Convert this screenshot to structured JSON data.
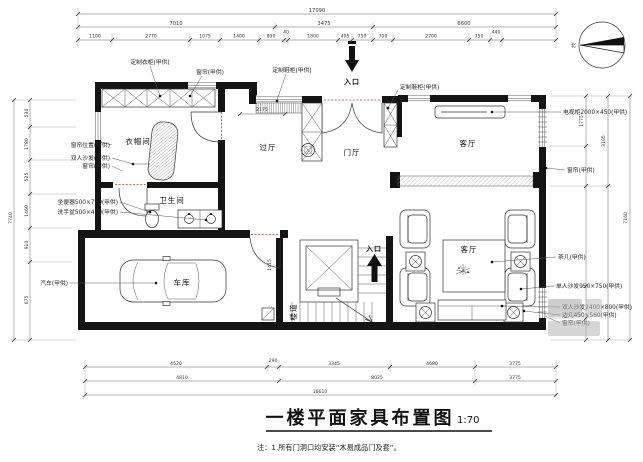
{
  "title": {
    "main": "一楼平面家具布置图",
    "scale": "1:70"
  },
  "note": "注：1.所有门洞口均安装“木易成品门及套”。",
  "compass_label": "北",
  "entries": {
    "top": "入口",
    "stairs": "入口"
  },
  "rooms": {
    "cloakroom": "衣帽间",
    "bathroom": "卫生间",
    "passage": "过厅",
    "foyer": "门厅",
    "living_upper": "客厅",
    "living_lower": "客厅",
    "garage": "车库",
    "stairwell": "楼道"
  },
  "labels": {
    "wardrobe": "定制衣柜(甲供)",
    "curtain_top": "窗帘(甲供)",
    "shoe_top": "定制鞋柜(甲供)",
    "shoe_right": "定制鞋柜(甲供)",
    "tv_cabinet": "电视柜2000×450(甲供)",
    "curtain_right_upper": "窗帘(甲供)",
    "tea_table": "茶几(甲供)",
    "single_sofa": "单人沙发950×750(甲供)",
    "double_sofa": "双人沙发2400×800(甲供)",
    "side_table": "边几450×560(甲供)",
    "curtain_right_lower": "窗帘(甲供)",
    "curtain_pos_left": "窗帘位置(甲供)",
    "sofa_left": "双人沙发(甲供)",
    "curtain_left": "窗帘(甲供)",
    "toilet": "坐便器500×720(甲供)",
    "basin": "洗手盆500×400(甲供)",
    "car": "汽车(甲供)"
  },
  "dims": {
    "top_total": "17090",
    "top_mid": [
      "7010",
      "3475",
      "6600"
    ],
    "top_small": [
      "1100",
      "2770",
      "1075",
      "1400",
      "890",
      "40",
      "1800",
      "495",
      "750",
      "700",
      "2700",
      "750",
      "440"
    ],
    "bottom_r1": [
      "4520",
      "290",
      "3345",
      "4680",
      "3775"
    ],
    "bottom_r2": [
      "4810",
      "8025",
      "3775"
    ],
    "bottom_total": "16610",
    "left_total": "7740",
    "left_segs": [
      "530",
      "1780",
      "525",
      "1460",
      "910",
      "675"
    ],
    "right_segs": [
      "1775",
      "3105"
    ],
    "right_total": "7160",
    "interior": [
      "2175",
      "1415"
    ]
  }
}
